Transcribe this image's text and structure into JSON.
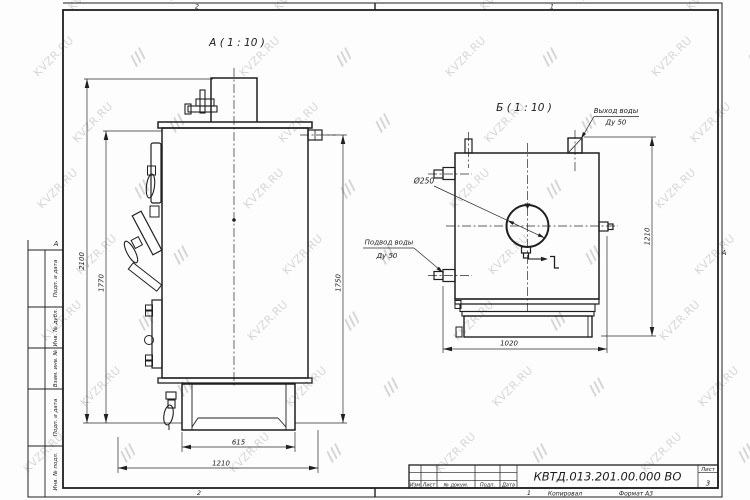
{
  "watermark": {
    "text": "KVZR.RU"
  },
  "frame": {
    "zone_top_left": "2",
    "zone_top_right": "1",
    "zone_bottom_left": "2",
    "zone_bottom_right": "1",
    "zone_letter_left": "А",
    "zone_letter_right": "А",
    "footer": {
      "copied": "Копировал",
      "format": "Формат А3"
    },
    "side_fields": [
      "Подп. и дата",
      "Инв. № дубл.",
      "Взам. инв. №",
      "Подп. и дата",
      "Инв. № подл."
    ]
  },
  "title_block": {
    "doc_number": "КВТД.013.201.00.000 ВО",
    "col_izm": "Изм",
    "col_list": "Лист",
    "col_doc": "№ докум.",
    "col_podp": "Подп.",
    "col_data": "Дата",
    "sheet_label": "Лист",
    "sheet_number": "3"
  },
  "view_a": {
    "title": "А ( 1 : 10 )",
    "dim_2100": "2100",
    "dim_1770": "1770",
    "dim_1750": "1750",
    "dim_615": "615",
    "dim_1210": "1210"
  },
  "view_b": {
    "title": "Б ( 1 : 10 )",
    "label_outlet_line1": "Выход воды",
    "label_outlet_line2": "Ду 50",
    "label_inlet_line1": "Подвод воды",
    "label_inlet_line2": "Ду 50",
    "label_diameter": "Ø250",
    "dim_1210": "1210",
    "dim_1020": "1020"
  }
}
